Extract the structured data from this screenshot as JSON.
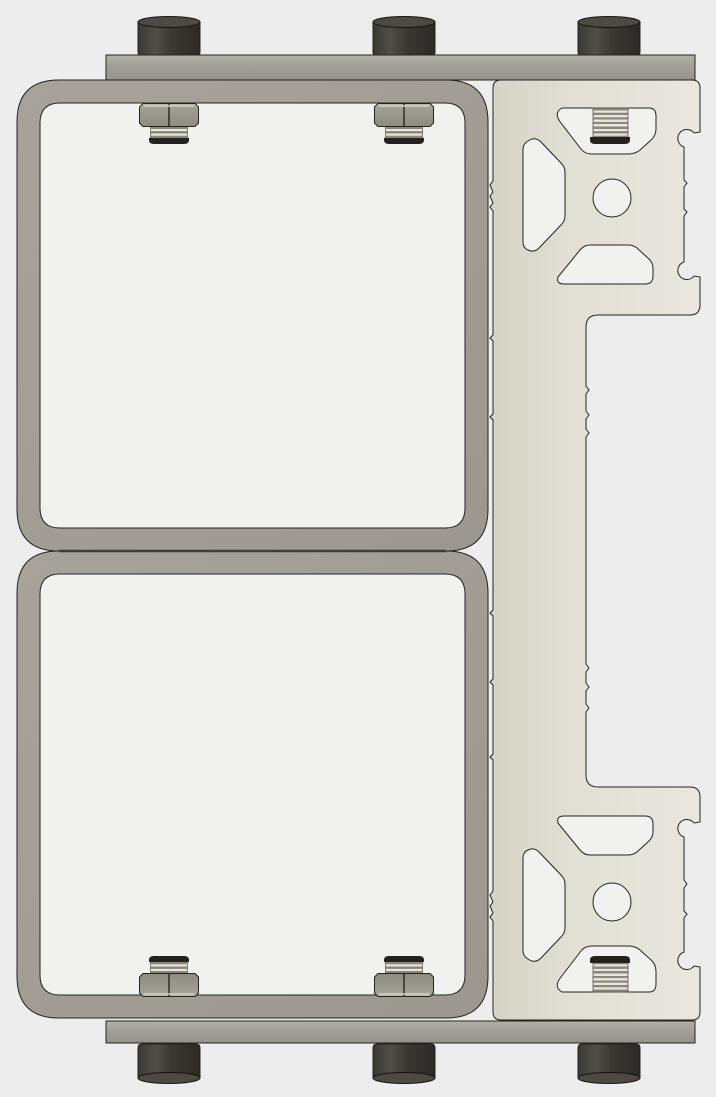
{
  "scene": {
    "type": "cad-render",
    "description": "Monochrome CAD render of a welded twin square-tube frame assembly fastened between two mounting rails and bolted to a T-slot aluminum extrusion rail on the right side",
    "text_content": "none"
  },
  "colors": {
    "bg": "#ecedec",
    "cutout": "#f1f2f0",
    "outline": "#23231f",
    "tube": "#a7a39a",
    "tubeDark": "#9c9890",
    "barTop": "#b4b1a8",
    "barMid": "#a5a299",
    "barBottom": "#96938a",
    "extrLeft": "#d5d2c6",
    "extrMid": "#e2dfd4",
    "extrRight": "#e9e7de",
    "headDark": "#2b2a26",
    "headMid": "#514e47",
    "headBase": "#3a3833",
    "headTop": "#4d4a44",
    "nutLight": "#c1beb4",
    "nutMid": "#a19e94",
    "nutDark": "#8e8b80",
    "threadLight": "#e9e6dd",
    "threadDark": "#8a877d",
    "studBase": "#23221e",
    "junction": "#3f3e39"
  },
  "parts": {
    "top_rail": {
      "label": "top mounting rail",
      "bolt_heads": 3
    },
    "bottom_rail": {
      "label": "bottom mounting rail",
      "bolt_heads": 3
    },
    "frame_upper": {
      "label": "upper square tube frame",
      "corner_style": "rounded"
    },
    "frame_lower": {
      "label": "lower square tube frame",
      "corner_style": "rounded"
    },
    "extrusion_rail": {
      "label": "T-slot aluminum extrusion rail",
      "cross_sections": 2,
      "center_holes": 2,
      "slot_cutouts_per_section": 3,
      "threaded_studs": 2
    },
    "fasteners": {
      "cap_bolts_total": 6,
      "hex_nuts_total": 4,
      "threaded_studs_in_frames": 4
    }
  }
}
